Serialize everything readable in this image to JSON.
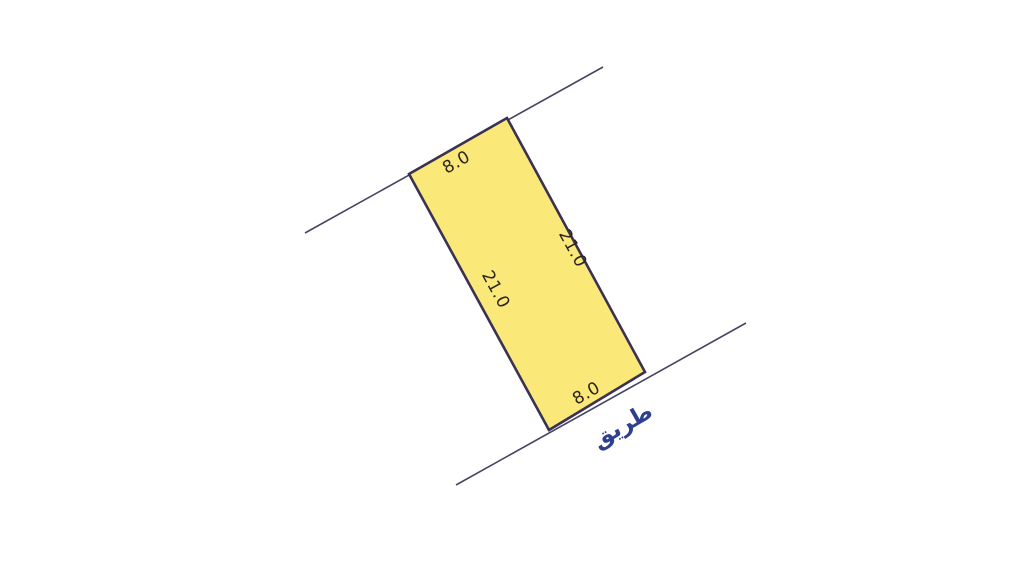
{
  "diagram": {
    "background_color": "#ffffff",
    "parcel": {
      "fill_color": "#FAE878",
      "border_color": "#3A3153",
      "dimensions": {
        "top": "8.0",
        "right": "21.0",
        "left": "21.0",
        "bottom": "8.0"
      }
    },
    "boundary_lines": {
      "color": "#464664"
    },
    "dimension_text_color": "#2A2420",
    "road": {
      "label": "طريق",
      "label_color": "#2D408F"
    }
  }
}
